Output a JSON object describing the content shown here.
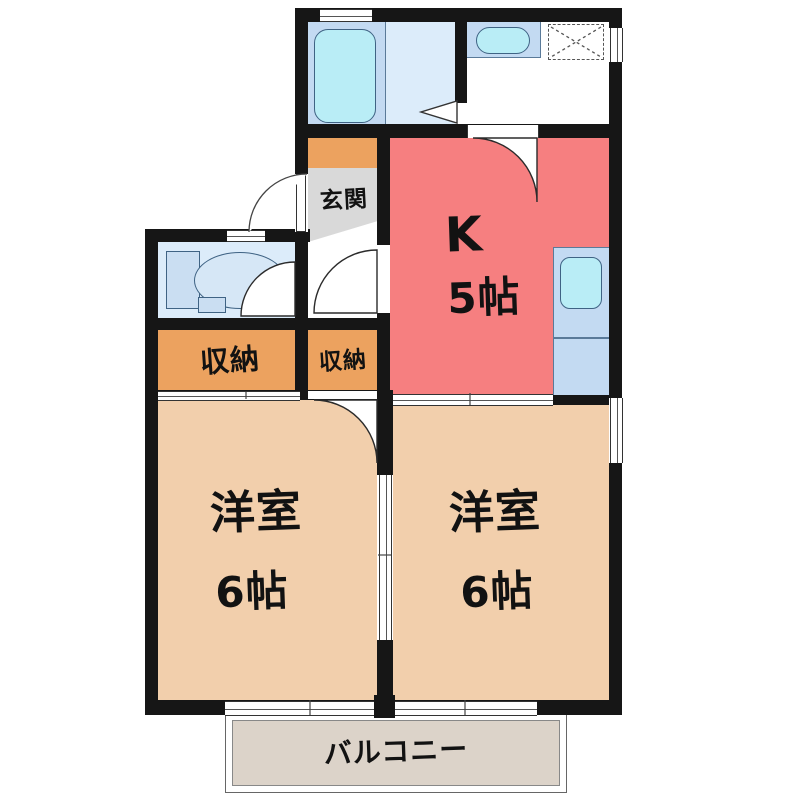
{
  "page": {
    "type": "floor-plan",
    "background": "#ffffff"
  },
  "colors": {
    "wall": "#161616",
    "kitchen": "#f67f80",
    "bedroom": "#f2cfac",
    "closet": "#eca25f",
    "balcony": "#dcd3c9",
    "bathroom": "#c3daf2",
    "waterRoom": "#dcecfa",
    "fixture": "#cadef2",
    "fixtureLight": "#d6e7f6",
    "tub": "#b9edf6",
    "entrance": "#d9d9d9"
  },
  "labels": {
    "entrance": "玄関",
    "kitchen_letter": "K",
    "kitchen_size": "5帖",
    "closet_left": "収納",
    "closet_right": "収納",
    "bedroom_left_name": "洋室",
    "bedroom_left_size": "6帖",
    "bedroom_right_name": "洋室",
    "bedroom_right_size": "6帖",
    "balcony": "バルコニー"
  },
  "fixtures": {
    "bathtub": "bathtub",
    "wash_basin": "wash-basin",
    "washing_machine_space": "washing-machine-space",
    "toilet": "toilet",
    "kitchen_sink": "kitchen-sink"
  }
}
